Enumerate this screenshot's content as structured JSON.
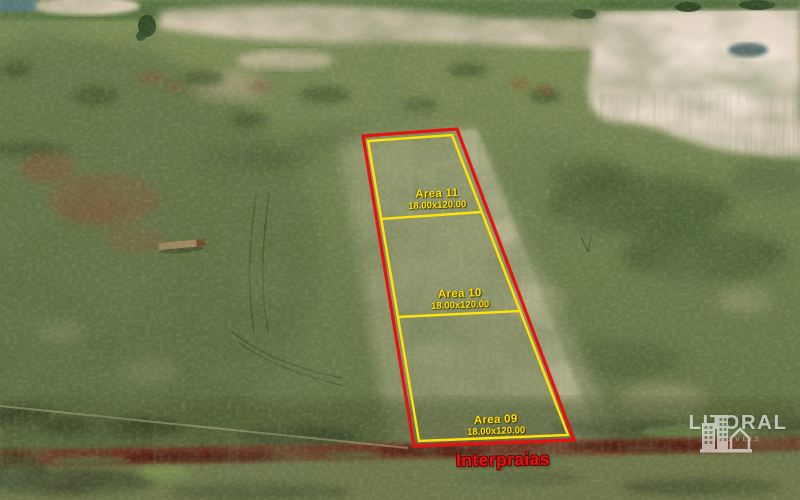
{
  "overlay": {
    "plots": [
      {
        "name": "Area 11",
        "dimensions": "18.00x120.00"
      },
      {
        "name": "Area 10",
        "dimensions": "18.00x120.00"
      },
      {
        "name": "Area 09",
        "dimensions": "18.00x120.00"
      }
    ],
    "brand_watermark": "Interpraias",
    "colors": {
      "plot_outline_outer": "#e41313",
      "plot_outline_inner": "#ffe20a",
      "area_label_text": "#ffdf06",
      "brand_watermark_text": "#e41212",
      "logo_watermark": "#ffffff"
    }
  },
  "logo": {
    "text": "LITORAL",
    "subtext": "IMÓVEIS",
    "icon": "city-skyline-house-icon"
  }
}
